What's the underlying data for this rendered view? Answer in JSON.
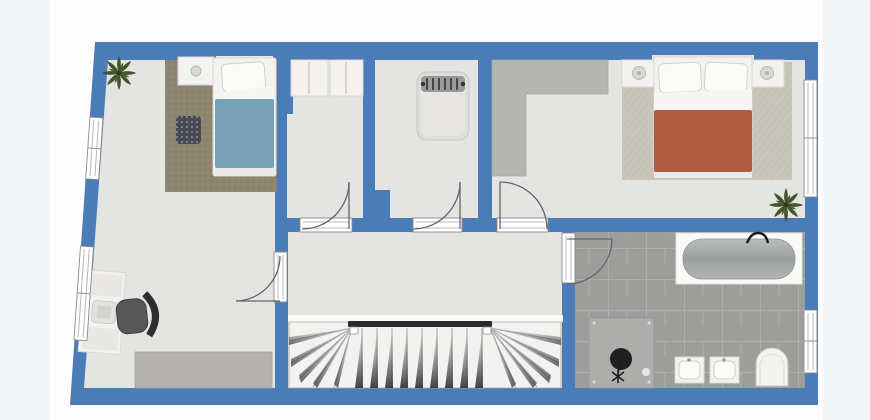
{
  "colors": {
    "page_background": "#f4f5f6",
    "plan_background": "#fdfdfd",
    "wall_blue": "#4a7cb8",
    "floor_gray": "#e4e4e2",
    "bath_tile": "#9d9d9b",
    "tile_grout": "#b2b2b0",
    "rug_brown": "#8e8571",
    "rug_beige": "#c9c5ba",
    "duvet_blue": "#78a1b6",
    "duvet_terracotta": "#ae5b42",
    "furniture_white": "#f3f2f0",
    "furniture_stroke": "#d8d8d6",
    "wardrobe_gray": "#b5b5b3",
    "dresser_gray": "#b2b1af",
    "stairs_white": "#f2f2f1",
    "handrail_dark": "#2b2b2b",
    "door_line": "#666666",
    "window_frame": "#8a8a8a",
    "plant_green": "#44552c",
    "chair_gray": "#575757",
    "shower_gray": "#adadab",
    "fixture_dark": "#202020"
  },
  "floorplan": {
    "type": "residential-upper-floor",
    "rooms": [
      {
        "name": "bedroom-left",
        "furniture": [
          "plant",
          "area-rug",
          "nightstand",
          "single-bed",
          "ottoman",
          "desk",
          "office-chair",
          "dresser"
        ]
      },
      {
        "name": "closet-room",
        "furniture": [
          "wardrobe-unit",
          "wardrobe-unit"
        ]
      },
      {
        "name": "nursery",
        "furniture": [
          "crib"
        ]
      },
      {
        "name": "master-bedroom",
        "furniture": [
          "built-in-wardrobe",
          "area-rug",
          "nightstand",
          "double-bed",
          "nightstand",
          "plant"
        ]
      },
      {
        "name": "hallway",
        "furniture": [
          "staircase",
          "handrail"
        ]
      },
      {
        "name": "bathroom",
        "furniture": [
          "bathtub",
          "shower",
          "sink-vanity",
          "sink-vanity",
          "toilet"
        ]
      }
    ],
    "door_count": 5,
    "window_count": 4
  }
}
